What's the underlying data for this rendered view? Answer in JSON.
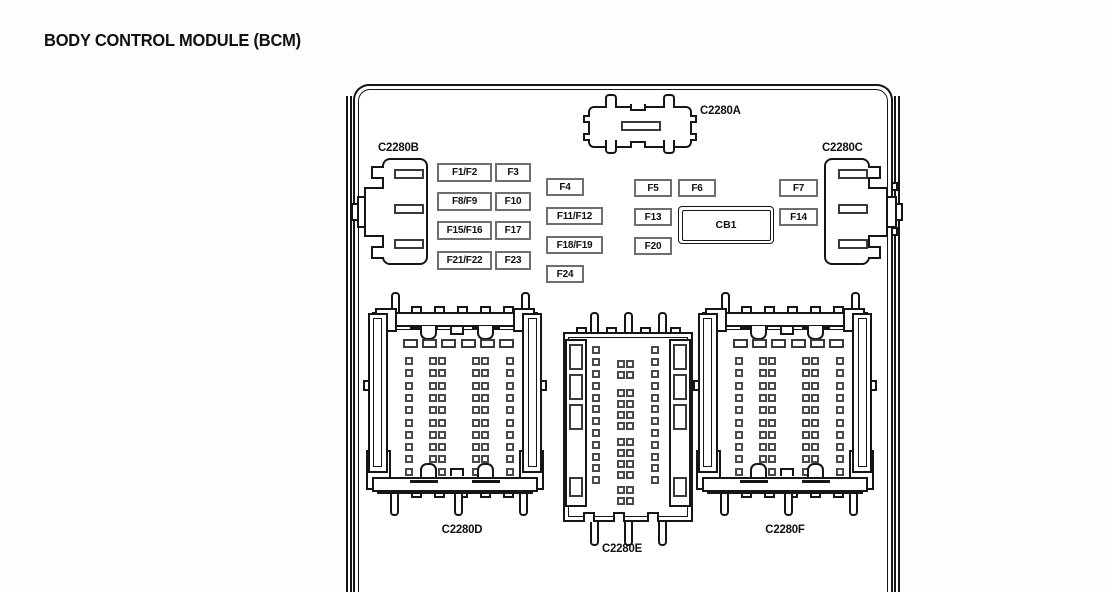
{
  "title": "BODY CONTROL MODULE (BCM)",
  "connectors": {
    "a": {
      "label": "C2280A"
    },
    "b": {
      "label": "C2280B"
    },
    "c": {
      "label": "C2280C"
    },
    "d": {
      "label": "C2280D"
    },
    "e": {
      "label": "C2280E"
    },
    "f": {
      "label": "C2280F"
    }
  },
  "fuses": [
    {
      "id": "F1/F2",
      "x": 437,
      "y": 163,
      "w": 55,
      "h": 19
    },
    {
      "id": "F3",
      "x": 495,
      "y": 163,
      "w": 36,
      "h": 19
    },
    {
      "id": "F8/F9",
      "x": 437,
      "y": 192,
      "w": 55,
      "h": 19
    },
    {
      "id": "F10",
      "x": 495,
      "y": 192,
      "w": 36,
      "h": 19
    },
    {
      "id": "F15/F16",
      "x": 437,
      "y": 221,
      "w": 55,
      "h": 19
    },
    {
      "id": "F17",
      "x": 495,
      "y": 221,
      "w": 36,
      "h": 19
    },
    {
      "id": "F21/F22",
      "x": 437,
      "y": 251,
      "w": 55,
      "h": 19
    },
    {
      "id": "F23",
      "x": 495,
      "y": 251,
      "w": 36,
      "h": 19
    },
    {
      "id": "F4",
      "x": 546,
      "y": 178,
      "w": 38,
      "h": 18
    },
    {
      "id": "F11/F12",
      "x": 546,
      "y": 207,
      "w": 57,
      "h": 18
    },
    {
      "id": "F18/F19",
      "x": 546,
      "y": 236,
      "w": 57,
      "h": 18
    },
    {
      "id": "F24",
      "x": 546,
      "y": 265,
      "w": 38,
      "h": 18
    },
    {
      "id": "F5",
      "x": 634,
      "y": 179,
      "w": 38,
      "h": 18
    },
    {
      "id": "F6",
      "x": 678,
      "y": 179,
      "w": 38,
      "h": 18
    },
    {
      "id": "F13",
      "x": 634,
      "y": 208,
      "w": 38,
      "h": 18
    },
    {
      "id": "F20",
      "x": 634,
      "y": 237,
      "w": 38,
      "h": 18
    },
    {
      "id": "F7",
      "x": 779,
      "y": 179,
      "w": 39,
      "h": 18
    },
    {
      "id": "F14",
      "x": 779,
      "y": 208,
      "w": 39,
      "h": 18
    }
  ],
  "breaker": {
    "label": "CB1",
    "x": 678,
    "y": 206,
    "w": 96,
    "h": 38
  },
  "colors": {
    "line": "#161616",
    "fuse_border": "#6e6e6e",
    "background": "#fdfdfc"
  }
}
